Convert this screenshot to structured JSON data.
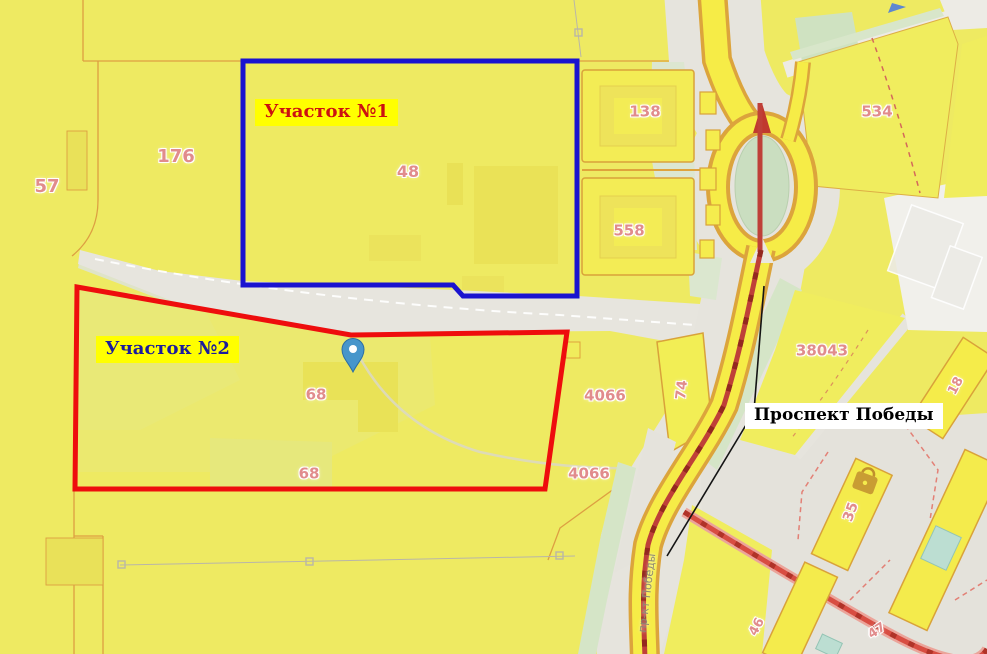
{
  "map": {
    "parcel_labels": [
      {
        "text": "57"
      },
      {
        "text": "176"
      },
      {
        "text": "48"
      },
      {
        "text": "138"
      },
      {
        "text": "558"
      },
      {
        "text": "534"
      },
      {
        "text": "38043"
      },
      {
        "text": "4066"
      },
      {
        "text": "4066"
      },
      {
        "text": "74"
      },
      {
        "text": "68"
      },
      {
        "text": "68"
      },
      {
        "text": "18"
      },
      {
        "text": "35"
      },
      {
        "text": "46"
      },
      {
        "text": "47"
      }
    ],
    "road_name_vertical": "пр-кт Победы"
  },
  "annotations": {
    "plot1_label": "Участок №1",
    "plot2_label": "Участок №2",
    "road_callout": "Проспект Победы"
  },
  "colors": {
    "plot1_outline": "#1a13cf",
    "plot2_outline": "#ee0d0d",
    "annotation_label_bg": "#ffff00",
    "plot1_text": "#cc1111",
    "plot2_text": "#1c1c9c",
    "callout_bg": "#ffffff",
    "callout_text": "#000000",
    "parcel_number_text": "#e18c8c",
    "pin_fill": "#4796cb"
  }
}
